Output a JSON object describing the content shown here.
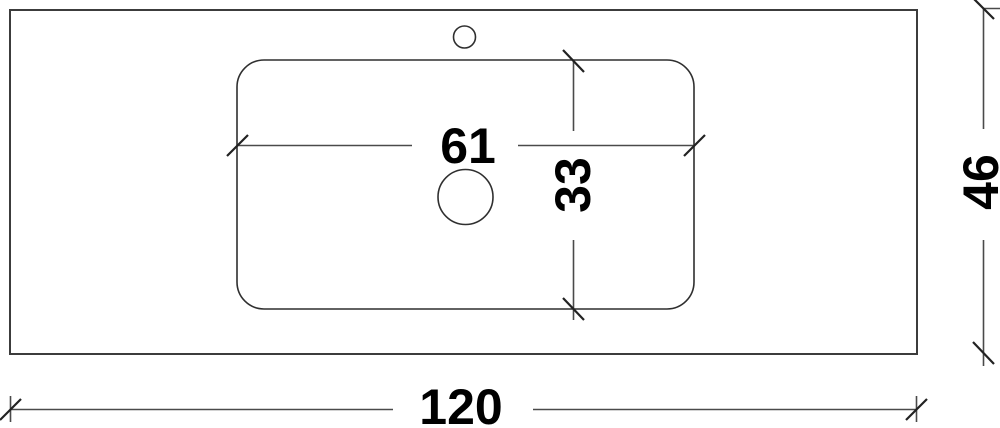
{
  "drawing": {
    "kind": "technical-drawing-top-view",
    "dim_labels": {
      "basin_width": "61",
      "basin_depth": "33",
      "countertop_width": "120",
      "countertop_depth": "46"
    },
    "colors": {
      "background": "#ffffff",
      "outline": "#3c3c3c",
      "dimension_line": "#4a4a4a",
      "tick": "#222222",
      "text": "#000000"
    }
  }
}
